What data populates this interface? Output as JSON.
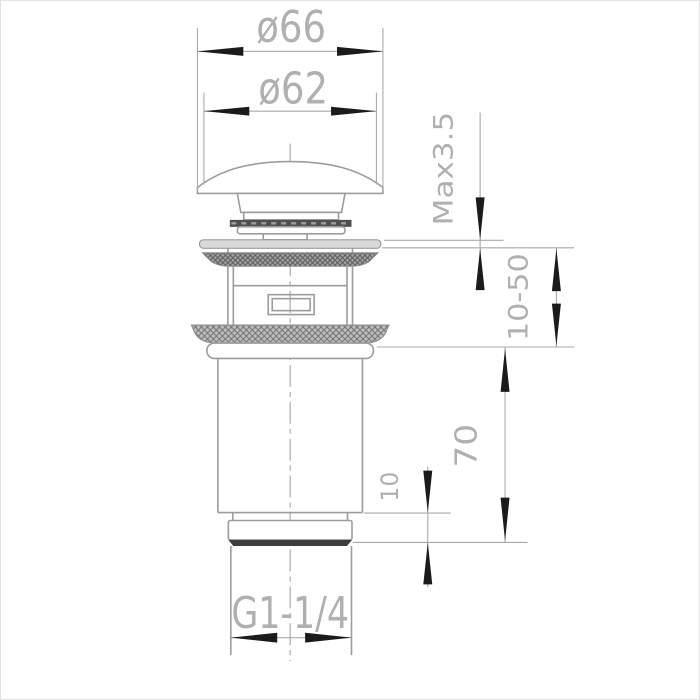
{
  "labels": {
    "top_outer_diameter": "ø66",
    "top_inner_diameter": "ø62",
    "flange_max_thickness": "Max3.5",
    "clamping_range": "10-50",
    "body_height": "70",
    "nut_height": "10",
    "thread_size": "G1-1/4"
  },
  "colors": {
    "line": "#9c9c9c",
    "dim": "#a9a9a9",
    "text": "#b0b0b0",
    "arrow": "#1b1b1b",
    "fill-light": "#d9d9d9",
    "fill-dark": "#4f4f4f",
    "band": "#3d3d3d",
    "background": "#ffffff",
    "border": "#e3e3e3"
  }
}
